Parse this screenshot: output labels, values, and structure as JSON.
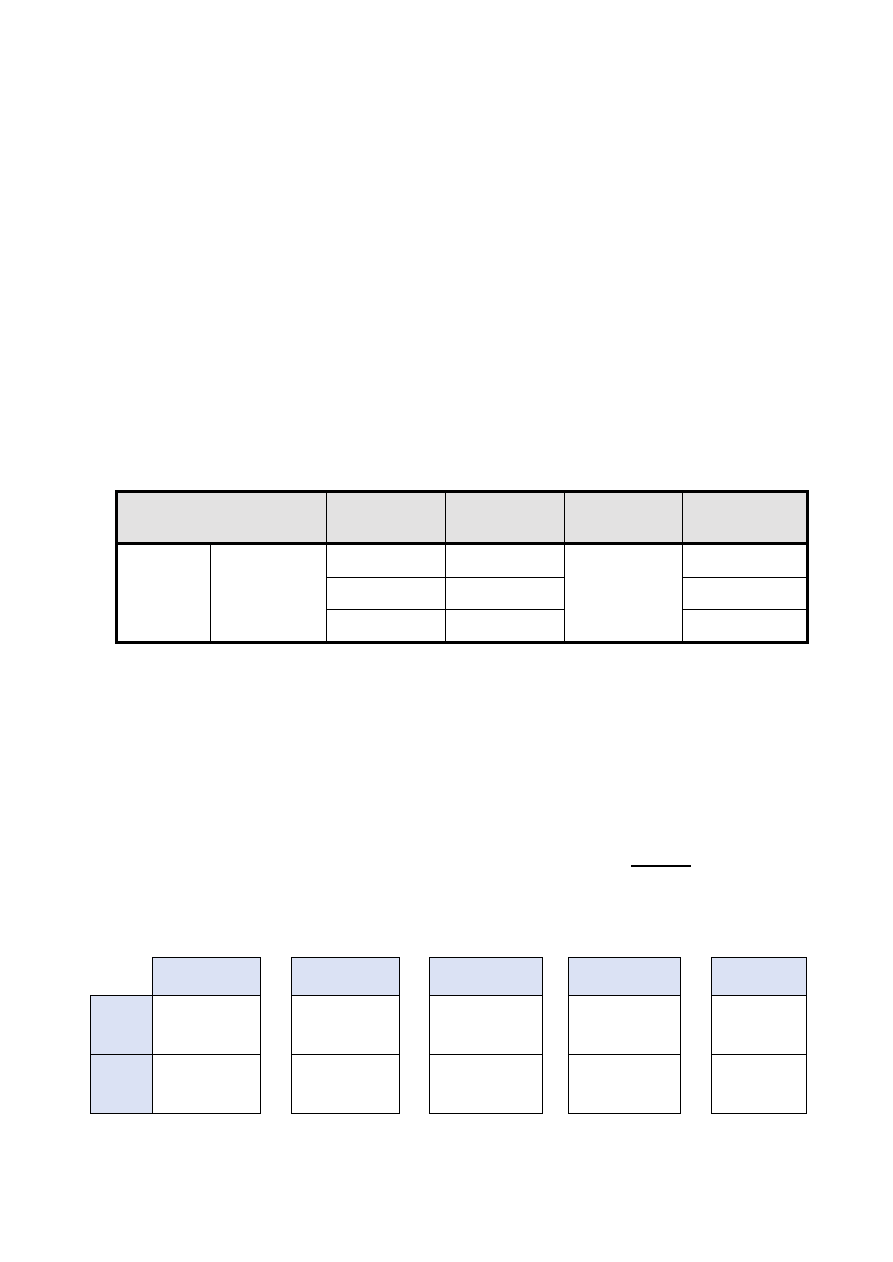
{
  "page": {
    "background": "#ffffff"
  },
  "colors": {
    "border": "#000000",
    "main_header_fill": "#e3e2e2",
    "small_header_fill": "#dbe2f4"
  },
  "main_table": {
    "header_cells": [
      "",
      "",
      "",
      "",
      ""
    ],
    "body": {
      "left_col1_cell": "",
      "left_col2_cell": "",
      "col3_rows": [
        "",
        "",
        ""
      ],
      "col4_rows": [
        "",
        "",
        ""
      ],
      "col5_cell": "",
      "col6_rows": [
        "",
        "",
        ""
      ]
    }
  },
  "blank_line": {
    "text": ""
  },
  "small_tables": [
    {
      "header": "",
      "left_labels": [
        "",
        ""
      ],
      "cells": [
        "",
        ""
      ]
    },
    {
      "header": "",
      "cells": [
        "",
        ""
      ]
    },
    {
      "header": "",
      "cells": [
        "",
        ""
      ]
    },
    {
      "header": "",
      "cells": [
        "",
        ""
      ]
    },
    {
      "header": "",
      "cells": [
        "",
        ""
      ]
    }
  ]
}
